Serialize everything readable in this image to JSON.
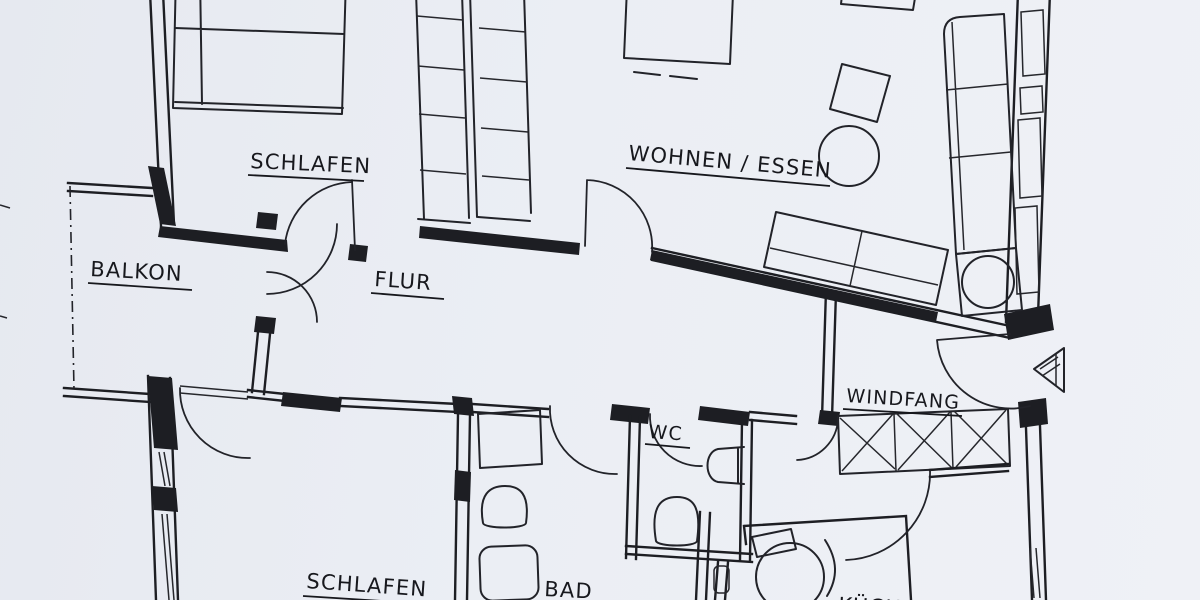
{
  "plan": {
    "rooms": [
      {
        "id": "schlafen-1",
        "label": "SCHLAFEN"
      },
      {
        "id": "wohnen-essen",
        "label": "WOHNEN / ESSEN"
      },
      {
        "id": "balkon",
        "label": "BALKON"
      },
      {
        "id": "flur",
        "label": "FLUR"
      },
      {
        "id": "schlafen-2",
        "label": "SCHLAFEN"
      },
      {
        "id": "bad",
        "label": "BAD"
      },
      {
        "id": "wc",
        "label": "WC"
      },
      {
        "id": "windfang",
        "label": "WINDFANG"
      },
      {
        "id": "kueche",
        "label": "KÜCHE"
      }
    ],
    "colors": {
      "paper": "#eaedf3",
      "ink": "#1d1e23"
    },
    "symbols": {
      "entrance_arrow": "triangle-pointing-left"
    }
  }
}
